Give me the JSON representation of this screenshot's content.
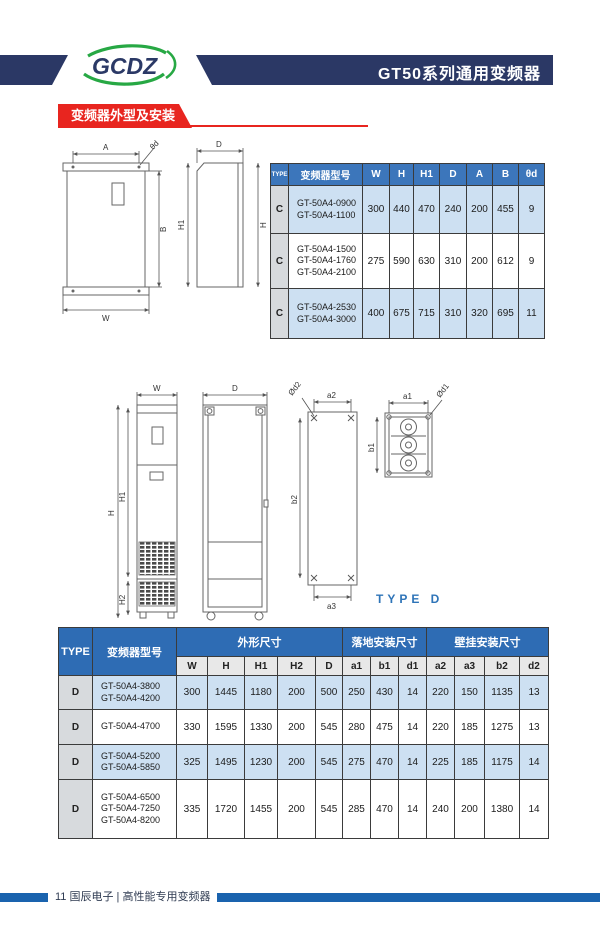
{
  "header": {
    "logo_text": "GCDZ",
    "title": "GT50系列通用变频器"
  },
  "section": {
    "title": "变频器外型及安装"
  },
  "figure1": {
    "front": {
      "top": "A",
      "hole": "θd",
      "right": "B",
      "bottom": "W"
    },
    "side": {
      "top": "D",
      "left": "H1",
      "right": "H"
    }
  },
  "figure2": {
    "front": {
      "top": "W",
      "left_outer": "H",
      "left_inner": "H1",
      "left_bottom": "H2"
    },
    "side": {
      "top": "D"
    },
    "wall": {
      "top": "a2",
      "hole": "Ød2",
      "left": "b2",
      "bottom": "a3"
    },
    "base": {
      "top": "a1",
      "hole": "Ød1",
      "left": "b1"
    },
    "caption": "TYPE D"
  },
  "table1": {
    "col_headers": [
      "TYPE",
      "变频器型号",
      "W",
      "H",
      "H1",
      "D",
      "A",
      "B",
      "θd"
    ],
    "rows": [
      {
        "type": "C",
        "models": [
          "GT-50A4-0900",
          "GT-50A4-1100"
        ],
        "values": [
          "300",
          "440",
          "470",
          "240",
          "200",
          "455",
          "9"
        ]
      },
      {
        "type": "C",
        "models": [
          "GT-50A4-1500",
          "GT-50A4-1760",
          "GT-50A4-2100"
        ],
        "values": [
          "275",
          "590",
          "630",
          "310",
          "200",
          "612",
          "9"
        ]
      },
      {
        "type": "C",
        "models": [
          "GT-50A4-2530",
          "GT-50A4-3000"
        ],
        "values": [
          "400",
          "675",
          "715",
          "310",
          "320",
          "695",
          "11"
        ]
      }
    ]
  },
  "table2": {
    "group_headers": {
      "type": "TYPE",
      "model": "变频器型号",
      "outline": "外形尺寸",
      "floor": "落地安装尺寸",
      "wall": "壁挂安装尺寸"
    },
    "sub_headers": [
      "W",
      "H",
      "H1",
      "H2",
      "D",
      "a1",
      "b1",
      "d1",
      "a2",
      "a3",
      "b2",
      "d2"
    ],
    "rows": [
      {
        "type": "D",
        "models": [
          "GT-50A4-3800",
          "GT-50A4-4200"
        ],
        "values": [
          "300",
          "1445",
          "1180",
          "200",
          "500",
          "250",
          "430",
          "14",
          "220",
          "150",
          "1135",
          "13"
        ]
      },
      {
        "type": "D",
        "models": [
          "GT-50A4-4700"
        ],
        "values": [
          "330",
          "1595",
          "1330",
          "200",
          "545",
          "280",
          "475",
          "14",
          "220",
          "185",
          "1275",
          "13"
        ]
      },
      {
        "type": "D",
        "models": [
          "GT-50A4-5200",
          "GT-50A4-5850"
        ],
        "values": [
          "325",
          "1495",
          "1230",
          "200",
          "545",
          "275",
          "470",
          "14",
          "225",
          "185",
          "1175",
          "14"
        ]
      },
      {
        "type": "D",
        "models": [
          "GT-50A4-6500",
          "GT-50A4-7250",
          "GT-50A4-8200"
        ],
        "values": [
          "335",
          "1720",
          "1455",
          "200",
          "545",
          "285",
          "470",
          "14",
          "240",
          "200",
          "1380",
          "14"
        ]
      }
    ]
  },
  "footer": {
    "page_number": "11",
    "text": "国辰电子 | 高性能专用变频器"
  },
  "colors": {
    "header_navy": "#2b3865",
    "accent_red": "#e8251f",
    "logo_green": "#27a844",
    "table1_header_blue": "#3c76bb",
    "table2_header_blue": "#2e6cb4",
    "row_light_blue": "#cde0f2",
    "type_cell_gray": "#d7dadd",
    "caption_blue": "#2e74b8",
    "footer_bar_blue": "#1a63ae"
  }
}
